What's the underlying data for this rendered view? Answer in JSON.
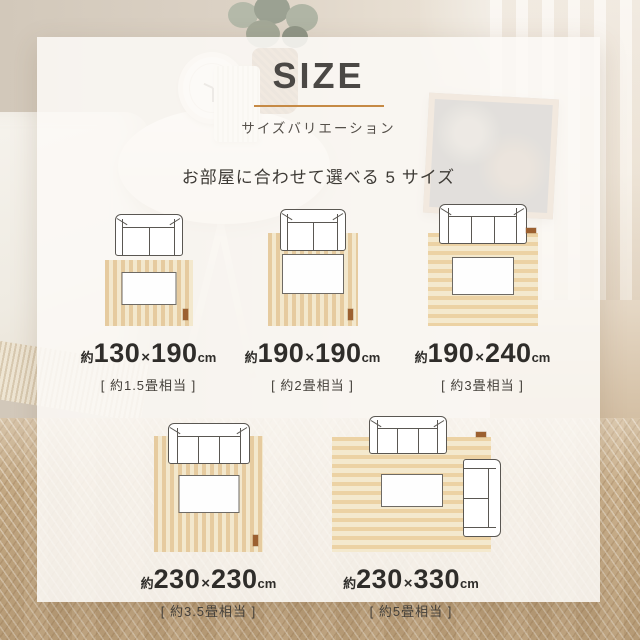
{
  "header": {
    "title": "SIZE",
    "subtitle": "サイズバリエーション",
    "tagline": "お部屋に合わせて選べる 5 サイズ"
  },
  "sizes": [
    {
      "approx": "約",
      "w": "130",
      "times": "×",
      "h": "190",
      "unit": "cm",
      "tatami": "[ 約1.5畳相当 ]",
      "sofa_seats": 2,
      "stripe_direction": "vertical"
    },
    {
      "approx": "約",
      "w": "190",
      "times": "×",
      "h": "190",
      "unit": "cm",
      "tatami": "[ 約2畳相当 ]",
      "sofa_seats": 2,
      "stripe_direction": "vertical"
    },
    {
      "approx": "約",
      "w": "190",
      "times": "×",
      "h": "240",
      "unit": "cm",
      "tatami": "[ 約3畳相当 ]",
      "sofa_seats": 3,
      "stripe_direction": "horizontal"
    },
    {
      "approx": "約",
      "w": "230",
      "times": "×",
      "h": "230",
      "unit": "cm",
      "tatami": "[ 約3.5畳相当 ]",
      "sofa_seats": 3,
      "stripe_direction": "vertical"
    },
    {
      "approx": "約",
      "w": "230",
      "times": "×",
      "h": "330",
      "unit": "cm",
      "tatami": "[ 約5畳相当 ]",
      "sofa_seats": 3,
      "extra_side_sofa_seats": 2,
      "stripe_direction": "horizontal"
    }
  ],
  "colors": {
    "accent_underline": "#c68a45",
    "card_background": "#fbf9f6",
    "rug_stripe_light": "#f3e8cd",
    "rug_stripe_dark": "#e6cb9f",
    "rug_stripe_h_light": "#f4e9ce",
    "rug_stripe_h_dark": "#ecd2a4",
    "rug_tag": "#9c6030",
    "furniture_outline": "#5a5752",
    "text_dark": "#2f2d2a",
    "floor_wood": "#c9ae88"
  }
}
